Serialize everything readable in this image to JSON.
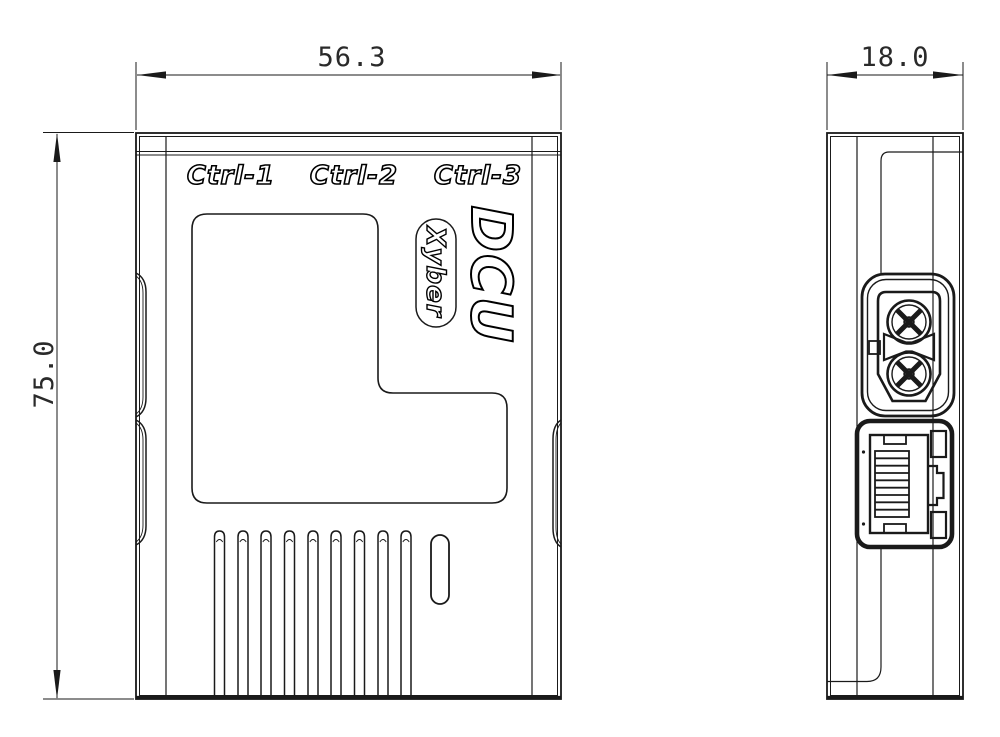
{
  "drawing": {
    "front_view": {
      "port_labels": [
        "Ctrl-1",
        "Ctrl-2",
        "Ctrl-3"
      ],
      "product_name": "DCU",
      "brand": "Xyber",
      "width_dim": "56.3",
      "height_dim": "75.0"
    },
    "side_view": {
      "depth_dim": "18.0"
    },
    "colors": {
      "line": "#1a1a1a",
      "background": "#ffffff"
    }
  }
}
